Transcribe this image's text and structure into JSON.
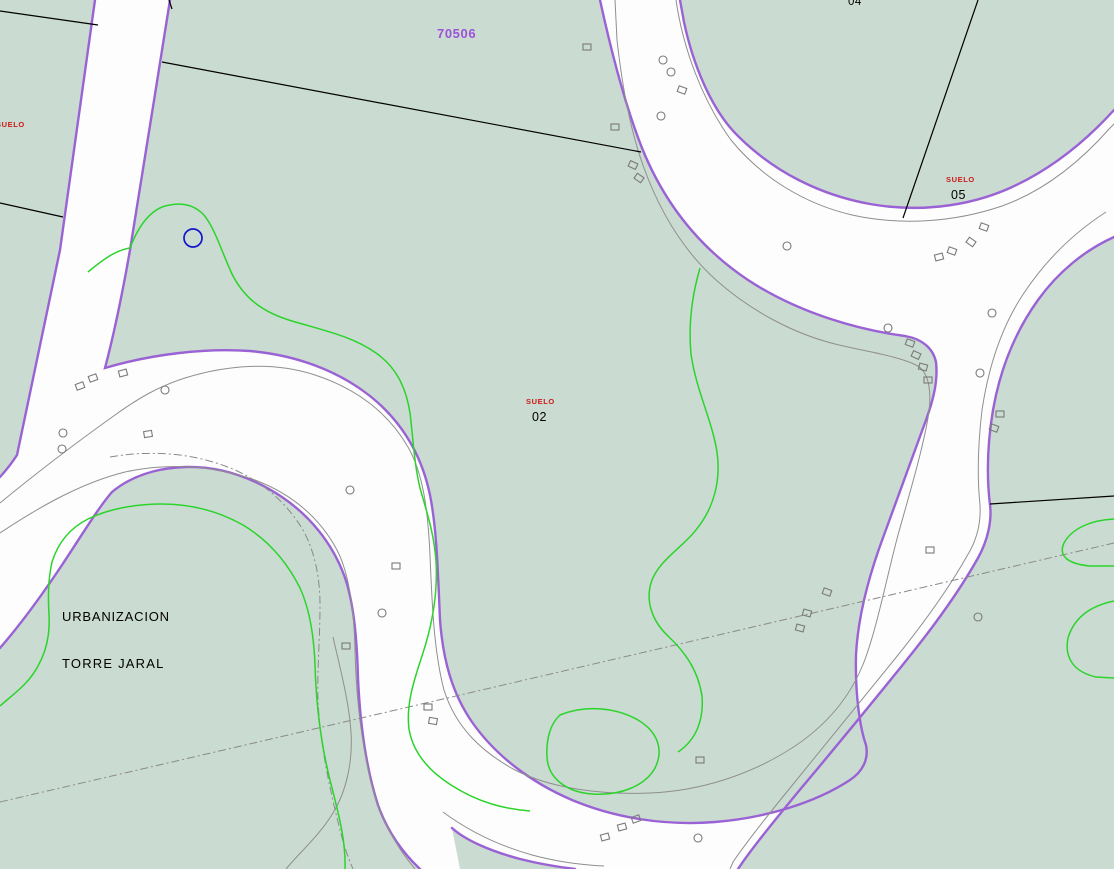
{
  "map": {
    "labels": {
      "parcel_number": "70506",
      "suelo_left": "SUELO",
      "suelo_02_title": "SUELO",
      "suelo_02_number": "02",
      "suelo_05_title": "SUELO",
      "suelo_05_number": "05",
      "parcel_04": "04",
      "urbanization_line1": "URBANIZACION",
      "urbanization_line2": "TORRE JARAL"
    },
    "colors": {
      "background_green": "#cadbd1",
      "road_white": "#fdfdfd",
      "boundary_purple": "#9a62d4",
      "parcel_number_purple": "#9d52d8",
      "suelo_red": "#cc1a1a",
      "contour_green": "#2bd42b",
      "curb_grey": "#8f8f8f",
      "symbol_grey": "#7a7a7a",
      "boundary_black": "#000000",
      "point_blue": "#1515cc"
    }
  }
}
